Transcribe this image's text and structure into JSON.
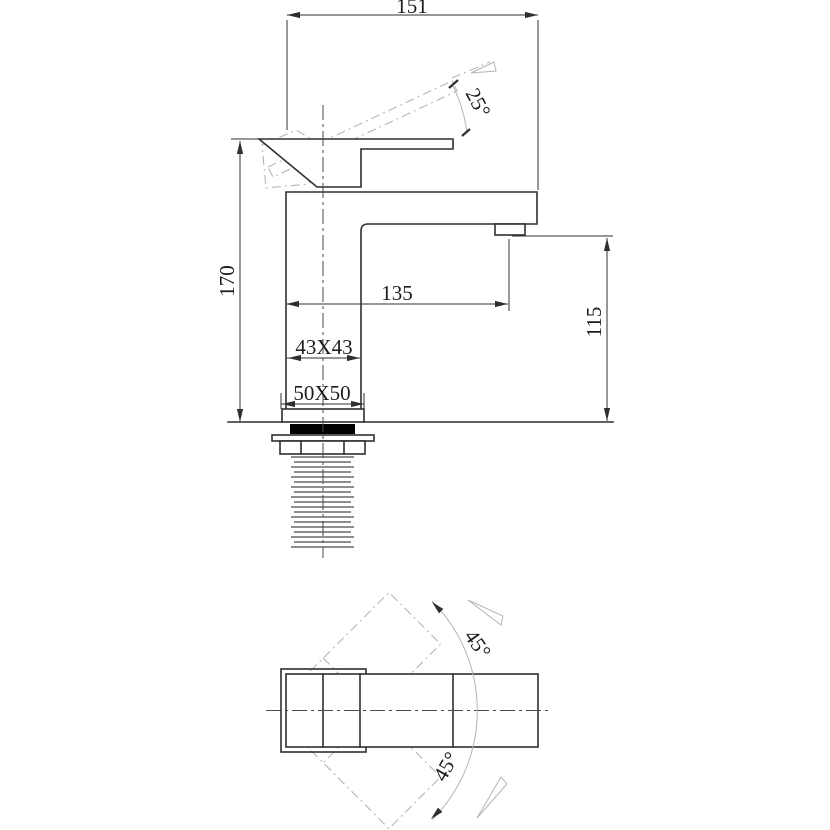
{
  "colors": {
    "line": "#2f2f2f",
    "dim": "#2f2f2f",
    "phantom": "#b5b5b5",
    "center": "#4a4a4a",
    "text": "#1c1c1c",
    "gasket": "#000000",
    "bg": "#ffffff"
  },
  "front_view": {
    "dim_width": "151",
    "dim_handle_angle": "25°",
    "dim_height": "170",
    "dim_reach": "135",
    "dim_outlet_height": "115",
    "dim_body_section": "43X43",
    "dim_base_section": "50X50"
  },
  "plan_view": {
    "dim_swing_up": "45°",
    "dim_swing_down": "45°"
  }
}
